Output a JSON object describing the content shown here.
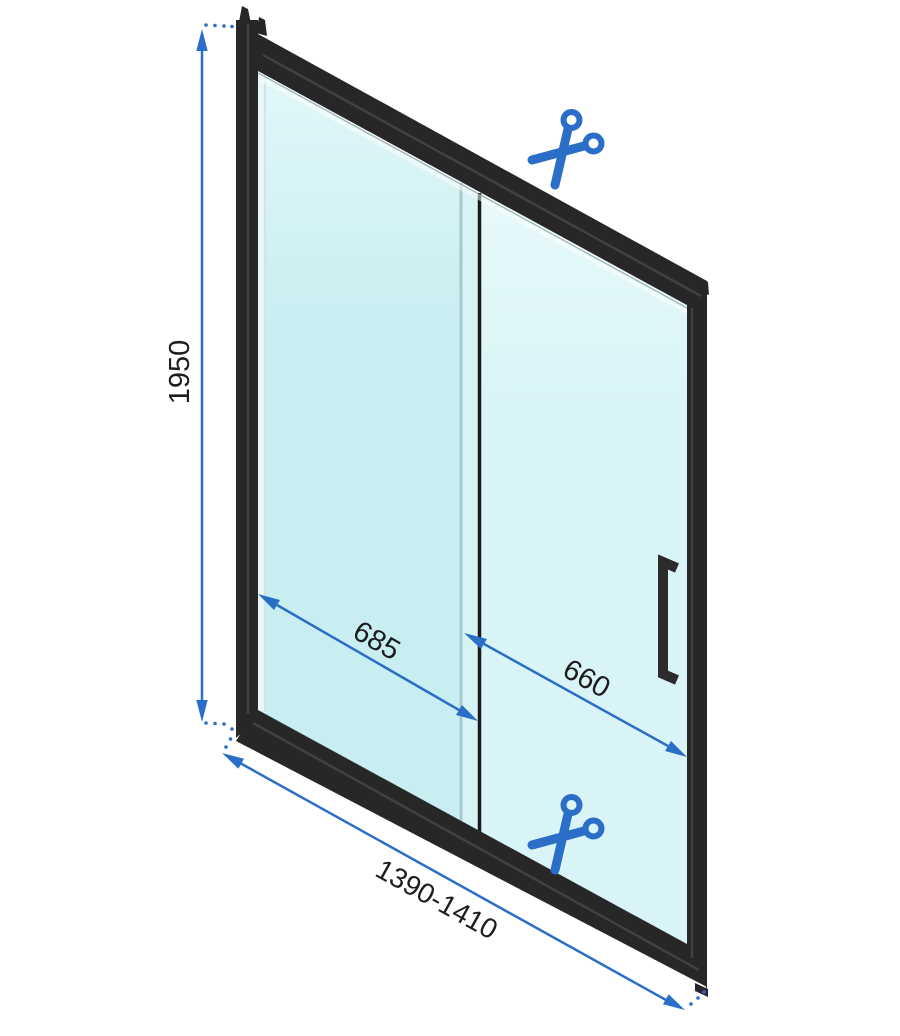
{
  "diagram": {
    "subject": "sliding shower door technical drawing, perspective view, black frame",
    "dimension_labels": {
      "height": "1950",
      "left_panel_width": "685",
      "right_panel_width": "660",
      "total_width_range": "1390-1410"
    },
    "icons": {
      "top": "scissors-icon",
      "bottom": "scissors-icon"
    },
    "colors": {
      "accent_blue": "#2b6ec8",
      "frame_black": "#272727",
      "glass_back": "#c9eef1",
      "glass_front": "#d9f5f7",
      "divider_black": "#1a1a1a",
      "label_text": "#1d1d1d",
      "background": "#ffffff"
    }
  }
}
